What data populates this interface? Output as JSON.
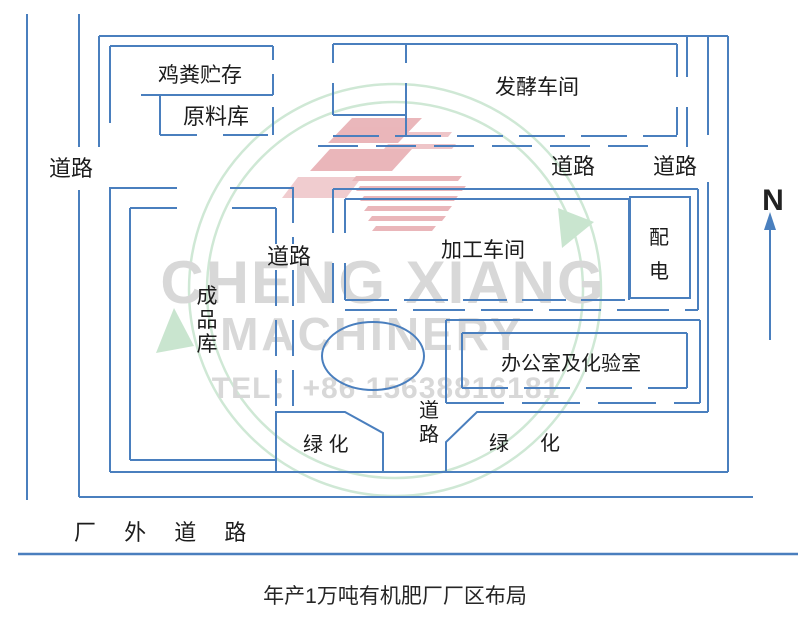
{
  "diagram": {
    "caption": "年产1万吨有机肥厂厂区布局",
    "north_label": "N",
    "labels": {
      "manure_storage": "鸡粪贮存",
      "raw_material_store": "原料库",
      "fermentation_workshop": "发酵车间",
      "processing_workshop": "加工车间",
      "power_room": "配电",
      "finished_goods_store": "成品库",
      "office_lab": "办公室及化验室",
      "green_left": "绿 化",
      "green_right": "绿化",
      "road_west": "道路",
      "road_middle": "道路",
      "road_east": "道路",
      "road_center": "道路",
      "road_south": "道路",
      "outer_road": "厂 外 道 路"
    },
    "watermark": {
      "line1": "CHENG XIANG",
      "line2": "MACHINERY",
      "line3": "TEL：+86 15638816181"
    },
    "colors": {
      "line_blue": "#4a7fbe",
      "label_text": "#1c1c1c",
      "watermark_gray": "#d8d8d8",
      "watermark_green": "#cfe8d5",
      "logo_red": "#cb4a55"
    }
  }
}
